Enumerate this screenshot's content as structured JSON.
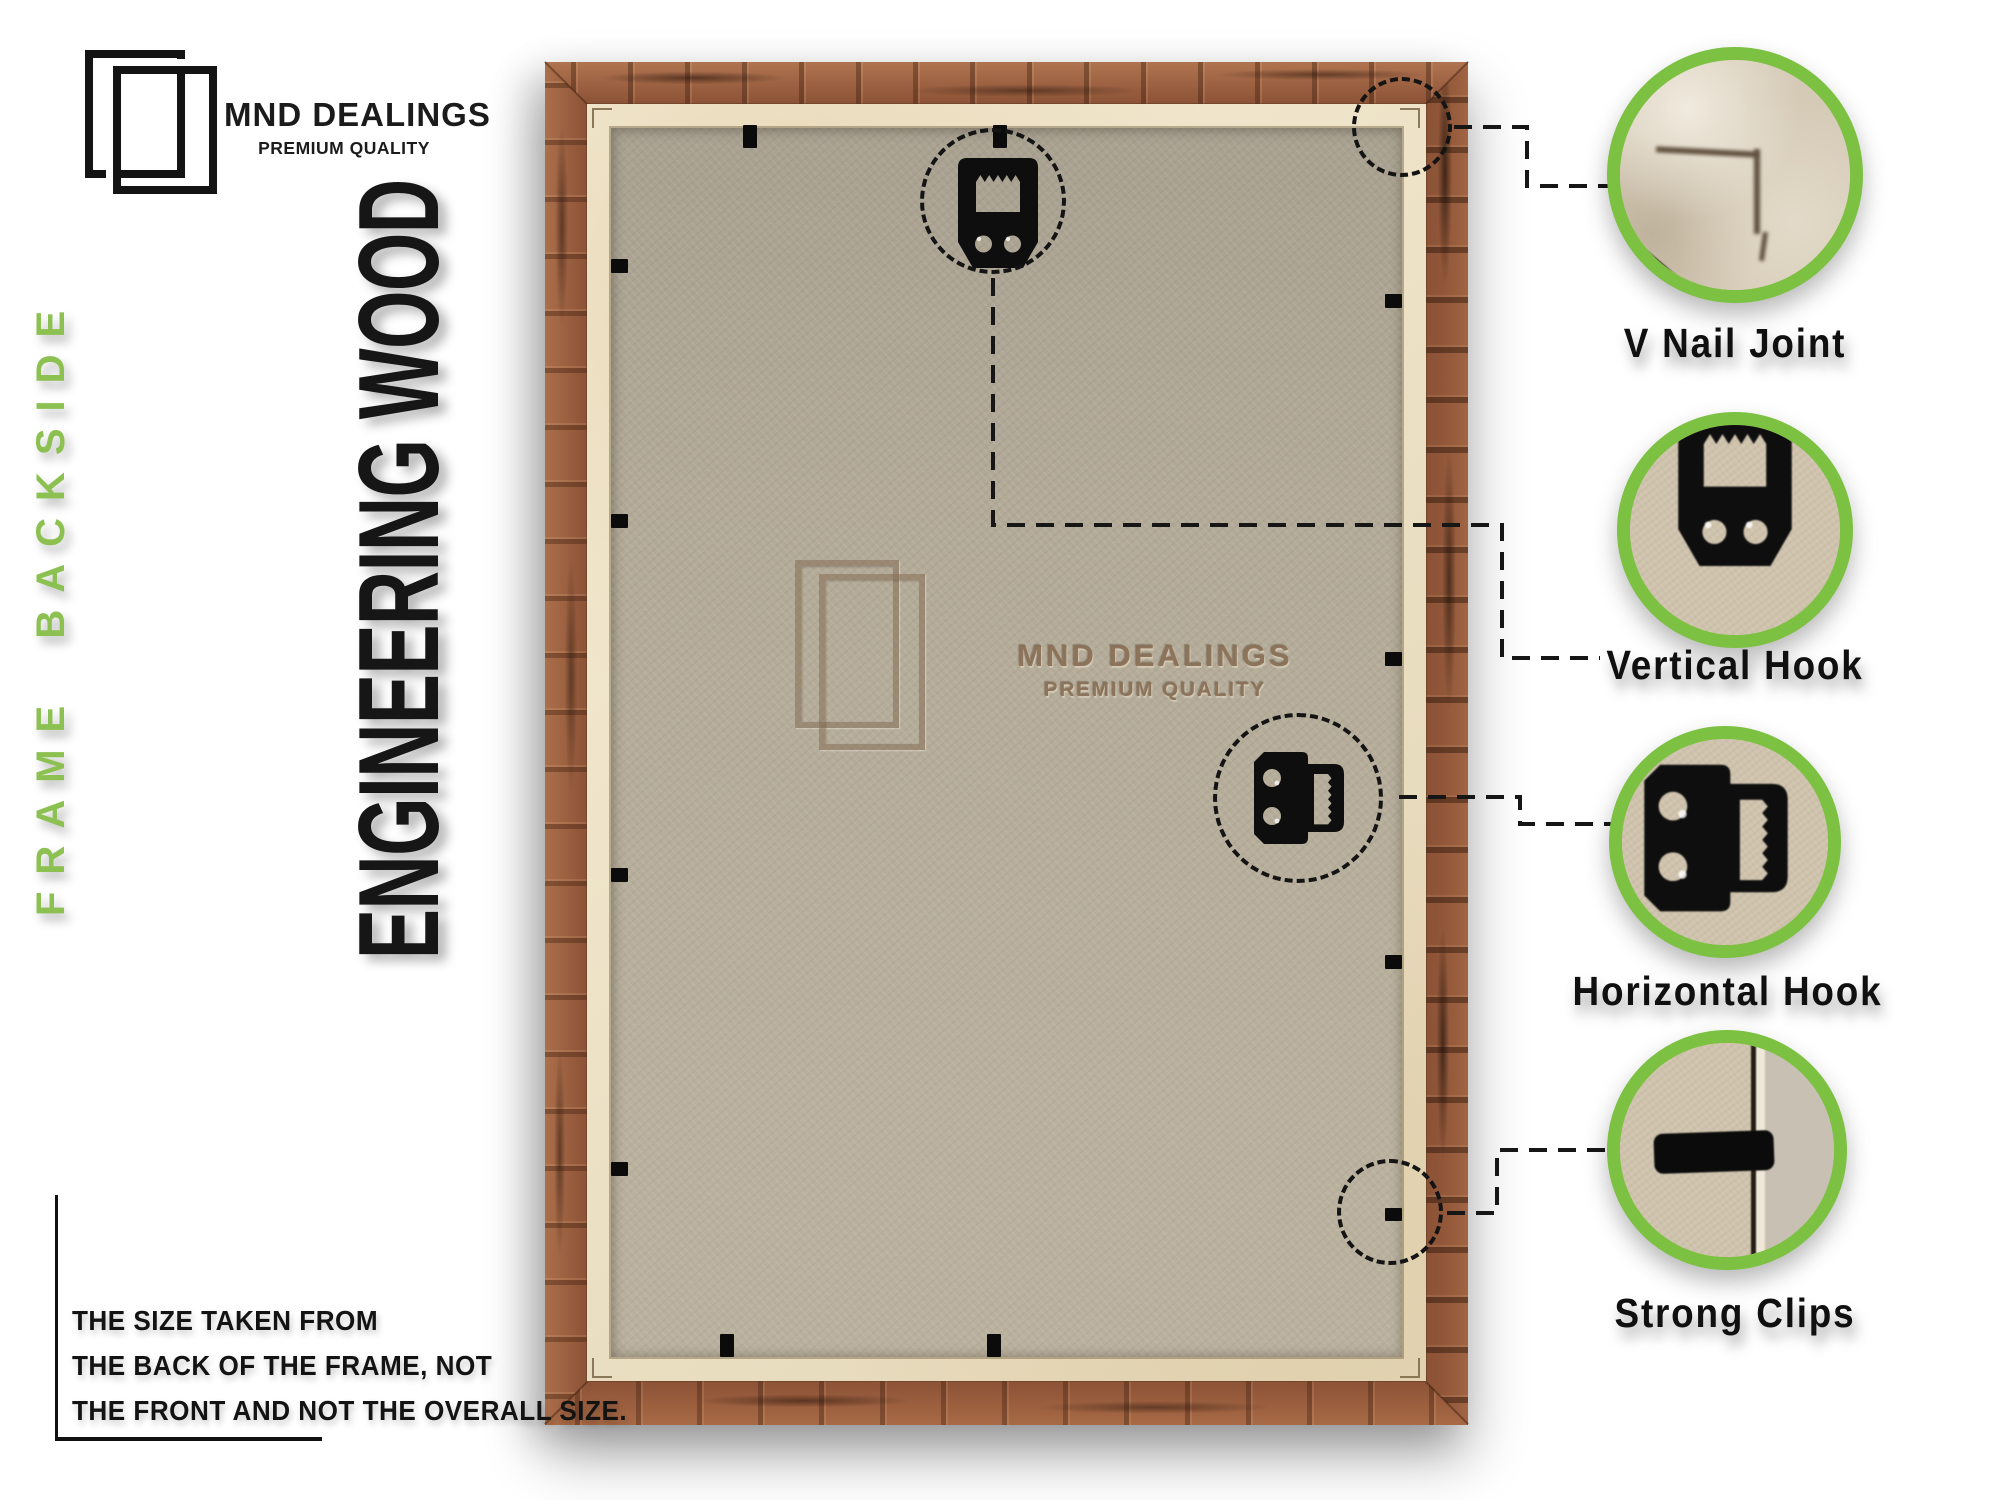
{
  "brand": {
    "name": "MND DEALINGS",
    "tagline": "PREMIUM QUALITY"
  },
  "labels": {
    "side": "FRAME BACKSIDE",
    "material": "ENGINEERING WOOD"
  },
  "watermark": {
    "name": "MND DEALINGS",
    "tagline": "PREMIUM QUALITY"
  },
  "callouts": [
    {
      "label": "V Nail Joint"
    },
    {
      "label": "Vertical Hook"
    },
    {
      "label": "Horizontal Hook"
    },
    {
      "label": "Strong Clips"
    }
  ],
  "note": {
    "lines": [
      "THE SIZE TAKEN FROM",
      "THE BACK OF THE FRAME, NOT",
      "THE FRONT AND NOT THE OVERALL SIZE."
    ]
  },
  "colors": {
    "accent_green": "#7dc142",
    "side_label_green": "#8cc152",
    "wood_brown": "#9c6040",
    "lip_beige": "#ecdebd",
    "mdf_gray": "#b2a997",
    "text_black": "#141414"
  }
}
